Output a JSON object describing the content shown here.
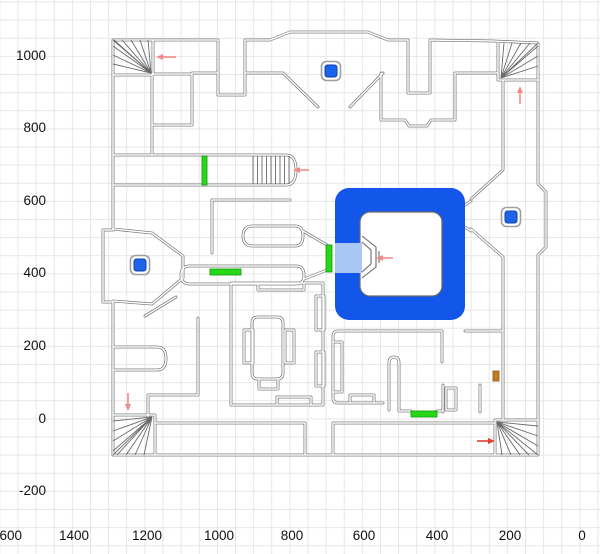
{
  "axes": {
    "x": {
      "labels": [
        "1600",
        "1400",
        "1200",
        "1000",
        "800",
        "600",
        "400",
        "200",
        "0"
      ]
    },
    "y": {
      "labels": [
        "1000",
        "800",
        "600",
        "400",
        "200",
        "0",
        "-200"
      ]
    }
  },
  "colors": {
    "wall": "#6a6a6a",
    "wall_inner": "#ffffff",
    "grid": "#e6e6e6",
    "zone_blue": "#1257ea",
    "zone_blue_border": "#0d3fae",
    "vestibule_blue": "#a9c6f4",
    "courtyard_white": "#ffffff",
    "marker_blue": "#1b64ea",
    "marker_border": "#0d3fa8",
    "marker_ring": "#9aa0a8",
    "door_green": "#27d817",
    "door_green_border": "#0f9a0a",
    "door_orange": "#c67b1e",
    "arrow_salmon": "#f18a8a",
    "arrow_red": "#e63c2e"
  },
  "map": {
    "markers": [
      {
        "x": 331,
        "y": 71
      },
      {
        "x": 140,
        "y": 265
      },
      {
        "x": 511,
        "y": 217
      }
    ],
    "doors": [
      {
        "x": 202,
        "y": 156,
        "w": 5,
        "h": 29,
        "color": "green"
      },
      {
        "x": 326,
        "y": 245,
        "w": 6,
        "h": 27,
        "color": "green"
      },
      {
        "x": 210,
        "y": 269,
        "w": 31,
        "h": 6,
        "color": "green"
      },
      {
        "x": 411,
        "y": 411,
        "w": 26,
        "h": 6,
        "color": "green"
      },
      {
        "x": 493,
        "y": 371,
        "w": 6,
        "h": 10,
        "color": "orange"
      }
    ],
    "arrows": [
      {
        "x1": 176,
        "y1": 57,
        "x2": 156,
        "y2": 57,
        "color": "salmon"
      },
      {
        "x1": 520,
        "y1": 104,
        "x2": 520,
        "y2": 86,
        "color": "salmon"
      },
      {
        "x1": 309,
        "y1": 170,
        "x2": 293,
        "y2": 170,
        "color": "salmon"
      },
      {
        "x1": 393,
        "y1": 258,
        "x2": 376,
        "y2": 258,
        "color": "salmon"
      },
      {
        "x1": 128,
        "y1": 393,
        "x2": 128,
        "y2": 411,
        "color": "salmon"
      },
      {
        "x1": 477,
        "y1": 441,
        "x2": 495,
        "y2": 441,
        "color": "red"
      }
    ]
  }
}
